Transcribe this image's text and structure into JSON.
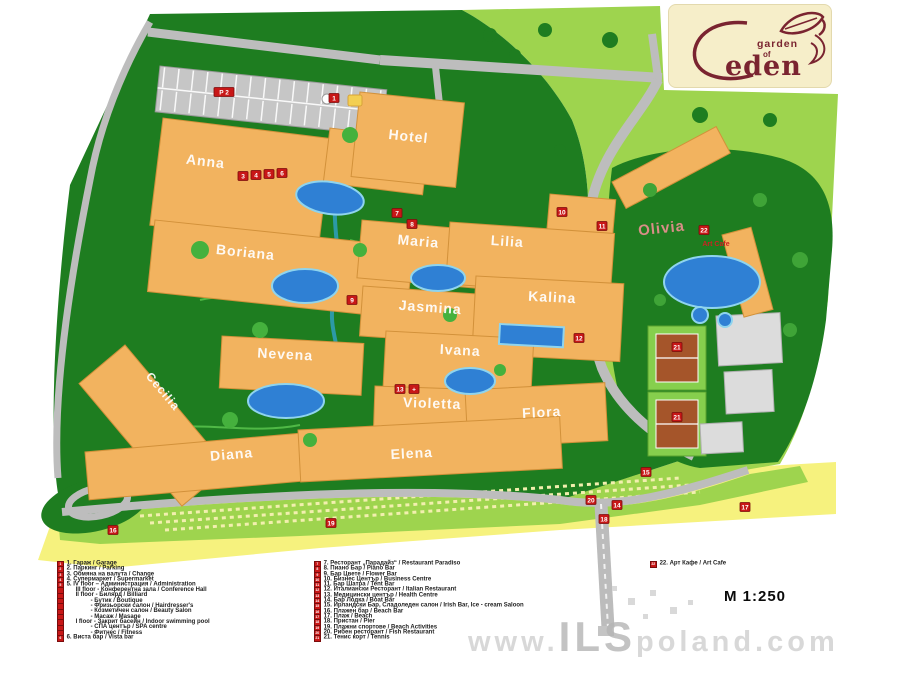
{
  "logo": {
    "garden": "garden",
    "of": "of",
    "eden": "eden",
    "color": "#7a2430",
    "bg": "#f6eec9"
  },
  "scale_label": "M 1:250",
  "watermark": {
    "prefix": "www.",
    "ils": "ILS",
    "suffix": "poland.com"
  },
  "map": {
    "colors": {
      "dark_green": "#1e7d20",
      "light_green": "#9ed44e",
      "sand_yellow": "#f6f27e",
      "road_gray": "#bdbdbd",
      "building_orange": "#f2b35f",
      "pool_blue": "#2f80d4",
      "marker_red": "#c81717",
      "tennis_clay": "#a5552a"
    },
    "building_labels": [
      "Anna",
      "Hotel",
      "Boriana",
      "Maria",
      "Lilia",
      "Jasmina",
      "Kalina",
      "Nevena",
      "Ivana",
      "Cecilia",
      "Violetta",
      "Flora",
      "Diana",
      "Elena",
      "Olivia"
    ],
    "art_cafe_label": "Art Cafe",
    "markers": [
      "P 2",
      "1",
      "3",
      "4",
      "5",
      "6",
      "7",
      "8",
      "9",
      "10",
      "11",
      "12",
      "13",
      "+",
      "14",
      "15",
      "16",
      "17",
      "18",
      "19",
      "20",
      "21",
      "21",
      "22"
    ]
  },
  "legend": {
    "col1": [
      {
        "chip": "1",
        "text": "1. Гараж / Garage"
      },
      {
        "chip": "2",
        "text": "2. Паркинг / Parking"
      },
      {
        "chip": "3",
        "text": "3. Обмяна на валута / Change"
      },
      {
        "chip": "4",
        "text": "4. Супермаркет / Supermarket"
      },
      {
        "chip": "5",
        "text": "5. IV floor – Администрация / Administration"
      },
      {
        "chip": "",
        "text": "III floor - Конферентна зала / Conference Hall"
      },
      {
        "chip": "",
        "text": "II floor - Билярд / Billiard"
      },
      {
        "chip": "",
        "text": "- Бутик / Boutique"
      },
      {
        "chip": "",
        "text": "- Фризьорски салон / Hairdresser's"
      },
      {
        "chip": "",
        "text": "- Козметичен салон / Beauty Salon"
      },
      {
        "chip": "",
        "text": "- Масаж / Masage"
      },
      {
        "chip": "",
        "text": "I floor - Закрит басейн / Indoor swimming pool"
      },
      {
        "chip": "",
        "text": "- СПА център / SPA centre"
      },
      {
        "chip": "",
        "text": "- Фитнес / Fitness"
      },
      {
        "chip": "6",
        "text": "6. Виста бар / Vista bar"
      }
    ],
    "col2": [
      {
        "chip": "7",
        "text": "7. Ресторант „Парадайз“ / Restaurant Paradiso"
      },
      {
        "chip": "8",
        "text": "8. Пиано Бар / Piano Bar"
      },
      {
        "chip": "9",
        "text": "9. Бар Цвете / Flower Bar"
      },
      {
        "chip": "10",
        "text": "10. Бизнес Център / Business Centre"
      },
      {
        "chip": "11",
        "text": "11. Бар Шатра / Tent Bar"
      },
      {
        "chip": "12",
        "text": "12. Италиански Ресторант / Italian Restaurant"
      },
      {
        "chip": "13",
        "text": "13. Медицински център / Health Centre"
      },
      {
        "chip": "14",
        "text": "14. Бар Лодка / Boat Bar"
      },
      {
        "chip": "15",
        "text": "15. Ирландски Бар, Сладоледен салон / Irish Bar, Ice - cream Saloon"
      },
      {
        "chip": "16",
        "text": "16. Плажен бар / Beach Bar"
      },
      {
        "chip": "17",
        "text": "17. Плаж / Beach"
      },
      {
        "chip": "18",
        "text": "18. Пристан / Pier"
      },
      {
        "chip": "19",
        "text": "19. Плажни спортове / Beach Activities"
      },
      {
        "chip": "20",
        "text": "20. Рибен ресторант / Fish Restaurant"
      },
      {
        "chip": "21",
        "text": "21. Тенис корт / Tennis"
      }
    ],
    "col3": [
      {
        "chip": "22",
        "text": "22. Арт Кафе / Art Cafe"
      }
    ]
  }
}
